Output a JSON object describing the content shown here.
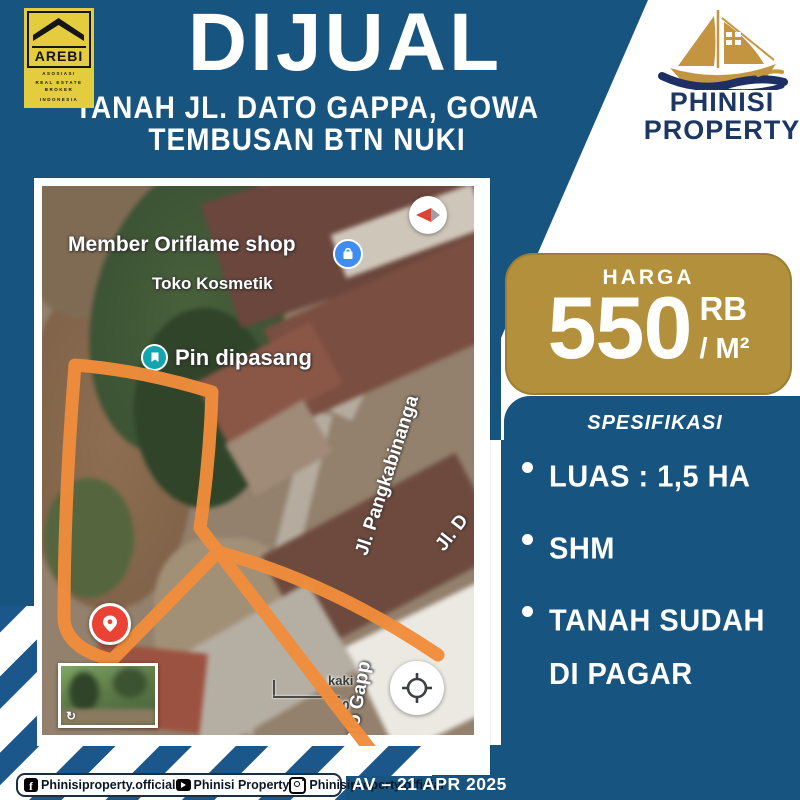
{
  "header": {
    "title": "DIJUAL",
    "subtitle_line1": "TANAH JL. DATO GAPPA, GOWA",
    "subtitle_line2": "TEMBUSAN BTN NUKI"
  },
  "arebi_logo": {
    "name": "AREBI",
    "tagline_line1": "ASOSIASI",
    "tagline_line2": "REAL ESTATE BROKER",
    "tagline_line3": "INDONESIA"
  },
  "phinisi_logo": {
    "line1": "PHINISI",
    "line2": "PROPERTY"
  },
  "map": {
    "poi_shop_label": "Member Oriflame shop",
    "poi_shop_sublabel": "Toko Kosmetik",
    "poi_pin_label": "Pin dipasang",
    "street_1": "Jl. Pangkabinanga",
    "street_2": "Jl. D",
    "street_3": "Jl. Dato Gapp",
    "scale_label_top": "kaki",
    "scale_label_bottom": "20",
    "streetview_rotate_icon": "↻"
  },
  "price": {
    "label": "HARGA",
    "amount": "550",
    "unit_sup": "RB",
    "unit": "/ M²"
  },
  "specs": {
    "title": "SPESIFIKASI",
    "items": [
      "LUAS : 1,5 HA",
      "SHM",
      "TANAH SUDAH DI PAGAR"
    ]
  },
  "footer": {
    "facebook_handle": "Phinisiproperty.official",
    "youtube_handle": "Phinisi Property",
    "instagram_handle": "Phinisiproperty.official",
    "stamp": "AV – 21 APR 2025"
  },
  "colors": {
    "background_blue": "#17547F",
    "badge_gold": "#B3903C",
    "plot_outline_orange": "#EF8C3B",
    "arebi_yellow": "#E3CC3D",
    "brand_navy": "#1D3765",
    "pin_red": "#EA4335",
    "poi_blue": "#3F8DF3",
    "poi_teal": "#12A4AF"
  }
}
